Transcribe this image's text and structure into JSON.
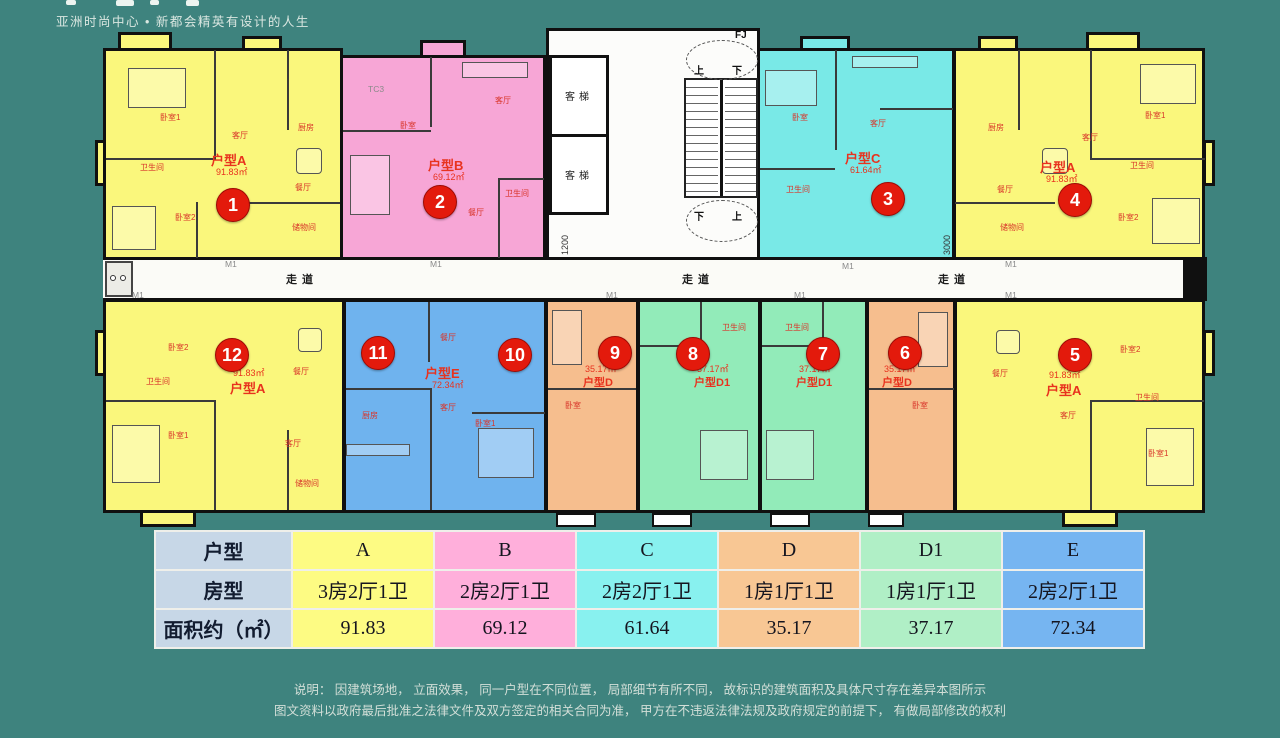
{
  "header": {
    "tagline": "亚洲时尚中心 • 新都会精英有设计的人生"
  },
  "plan": {
    "corridor": {
      "zd": "走道",
      "m1": "M1"
    },
    "core": {
      "elevator": "客梯",
      "up": "上",
      "down": "下",
      "fj": "FJ",
      "tc3": "TC3",
      "dim1": "1200",
      "dim2": "3000"
    },
    "units": {
      "u1": {
        "num": "1",
        "type": "户型A",
        "area": "91.83㎡",
        "color": "#FAF77C",
        "rooms": {
          "r1": "卧室1",
          "r2": "厨房",
          "r3": "客厅",
          "r4": "卫生间",
          "r5": "卧室2",
          "r6": "餐厅",
          "r7": "储物间"
        }
      },
      "u2": {
        "num": "2",
        "type": "户型B",
        "area": "69.12㎡",
        "color": "#F7A6D6",
        "rooms": {
          "r1": "卧室",
          "r2": "客厅",
          "r3": "餐厅",
          "r4": "卫生间"
        }
      },
      "u3": {
        "num": "3",
        "type": "户型C",
        "area": "61.64㎡",
        "color": "#79E9E7",
        "rooms": {
          "r1": "卧室",
          "r2": "客厅",
          "r3": "卫生间"
        }
      },
      "u4": {
        "num": "4",
        "type": "户型A",
        "area": "91.83㎡",
        "color": "#FAF77C",
        "rooms": {
          "r1": "厨房",
          "r2": "餐厅",
          "r3": "储物间",
          "r4": "卧室2",
          "r5": "卫生间",
          "r6": "卧室1",
          "r7": "客厅"
        }
      },
      "u5": {
        "num": "5",
        "type": "户型A",
        "area": "91.83㎡",
        "color": "#FAF77C",
        "rooms": {
          "r1": "卧室2",
          "r2": "餐厅",
          "r3": "客厅",
          "r4": "卫生间",
          "r5": "卧室1"
        }
      },
      "u6": {
        "num": "6",
        "type": "户型D",
        "area": "35.17㎡",
        "color": "#F6BE8E",
        "rooms": {
          "r1": "卧室"
        }
      },
      "u7": {
        "num": "7",
        "type": "户型D1",
        "area": "37.17㎡",
        "color": "#92EBB9",
        "rooms": {
          "r1": "卫生间"
        }
      },
      "u8": {
        "num": "8",
        "type": "户型D1",
        "area": "37.17㎡",
        "color": "#92EBB9",
        "rooms": {
          "r1": "卫生间"
        }
      },
      "u9": {
        "num": "9",
        "type": "户型D",
        "area": "35.17㎡",
        "color": "#F6BE8E",
        "rooms": {
          "r1": "卧室"
        }
      },
      "ue": {
        "num10": "10",
        "num11": "11",
        "type": "户型E",
        "area": "72.34㎡",
        "color": "#6FB3EE",
        "rooms": {
          "r1": "餐厅",
          "r2": "厨房",
          "r3": "客厅",
          "r4": "卧室1"
        }
      },
      "u12": {
        "num": "12",
        "type": "户型A",
        "area": "91.83㎡",
        "color": "#FAF77C",
        "rooms": {
          "r1": "卧室2",
          "r2": "餐厅",
          "r3": "卫生间",
          "r4": "卧室1",
          "r5": "客厅",
          "r6": "储物间"
        }
      }
    }
  },
  "table": {
    "header_col": {
      "row1": "户型",
      "row2": "房型",
      "row3": "面积约（㎡）"
    },
    "columns": {
      "a": {
        "type": "A",
        "layout": "3房2厅1卫",
        "area": "91.83",
        "color": "#FDFB83"
      },
      "b": {
        "type": "B",
        "layout": "2房2厅1卫",
        "area": "69.12",
        "color": "#FFAFDB"
      },
      "c": {
        "type": "C",
        "layout": "2房2厅1卫",
        "area": "61.64",
        "color": "#88F1EF"
      },
      "d": {
        "type": "D",
        "layout": "1房1厅1卫",
        "area": "35.17",
        "color": "#F8C794"
      },
      "d1": {
        "type": "D1",
        "layout": "1房1厅1卫",
        "area": "37.17",
        "color": "#B0EFC6"
      },
      "e": {
        "type": "E",
        "layout": "2房2厅1卫",
        "area": "72.34",
        "color": "#76B5F1"
      }
    },
    "header_bg": "#C7D7E7"
  },
  "disclaimer": {
    "line1": "说明： 因建筑场地， 立面效果， 同一户型在不同位置， 局部细节有所不同， 故标识的建筑面积及具体尺寸存在差异本图所示",
    "line2": "图文资料以政府最后批准之法律文件及双方签定的相关合同为准， 甲方在不违返法律法规及政府规定的前提下， 有做局部修改的权利"
  },
  "colors": {
    "background": "#3E837E",
    "badge": "#E31A0C",
    "label_red": "#E8321E",
    "wall": "#101010"
  }
}
